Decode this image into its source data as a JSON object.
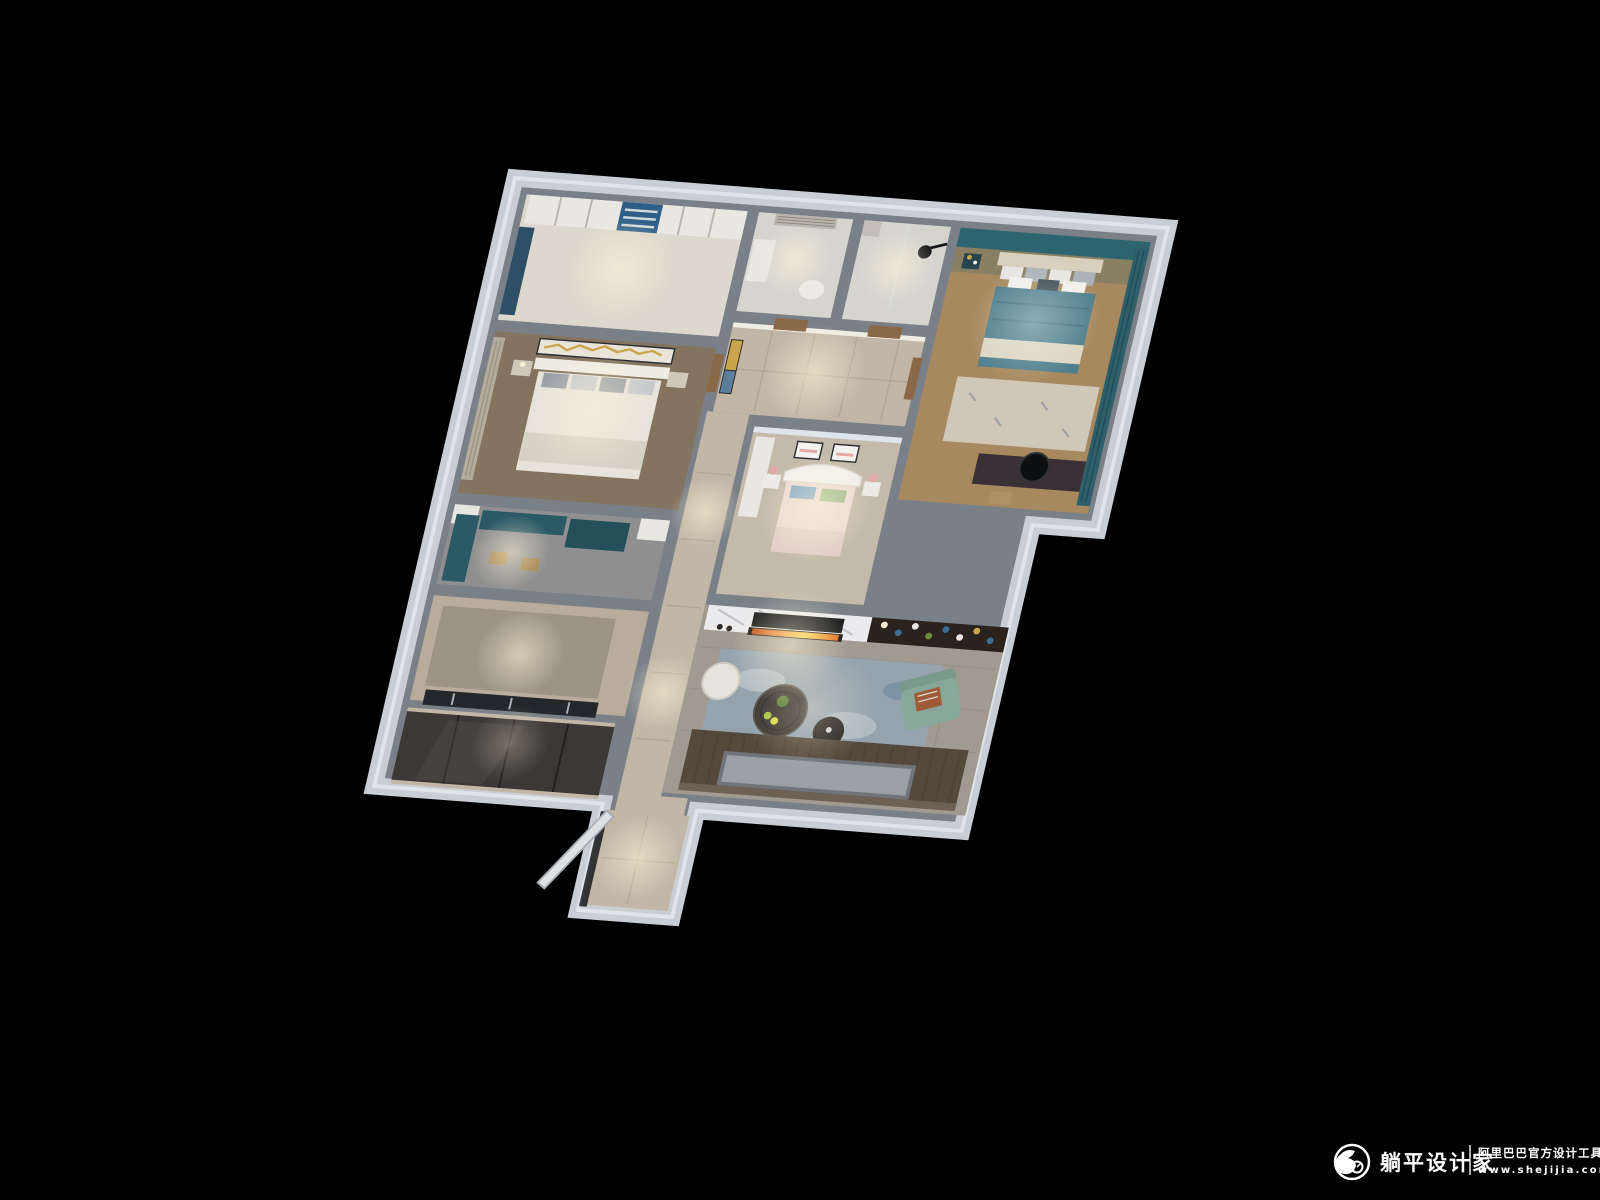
{
  "watermark": {
    "brand": "躺平设计家",
    "tagline": "阿里巴巴官方设计工具",
    "url": "www.shejijia.com",
    "logo_icon": "shejijia-sloth-logo",
    "color": "#ffffff"
  },
  "colors": {
    "background": "#000000",
    "wall_band": "#c9ced4",
    "wall_gray": "#7a8088",
    "wall_lit": "#f0ede4",
    "floor_light": "#ddd8cd",
    "floor_wood_dark": "#84745f",
    "floor_concrete": "#8f8f8f",
    "floor_kitchen": "#b9ac9a",
    "floor_beige": "#c2b7a6",
    "floor_bath": "#d6d4cf",
    "floor_kids": "#c4baa9",
    "floor_wood": "#a8895f",
    "floor_tile": "#a09a91",
    "cabinet_dark": "#3b3835",
    "wardrobe_white": "#e9e7e2",
    "shelf_blue": "#2e5f88",
    "desk_teal": "#2b5a66",
    "accent_teal": "#2c6470",
    "blanket_teal": "#4f7e8d",
    "throw_cream": "#ded6c2",
    "marble_white": "#ebebed",
    "tv_black": "#17181a",
    "shelving_brown": "#29221d",
    "armchair_sage": "#88a89b",
    "pillow_rust": "#a05a38",
    "rug_blue": "#93a4b2",
    "sofa_brown": "#55493c",
    "sofa_panel": "#9aa0a4",
    "door_wood": "#8a6848",
    "art_gold": "#c9a54d",
    "art_blue": "#5b7f9a",
    "glass_dark": "#23272b"
  }
}
